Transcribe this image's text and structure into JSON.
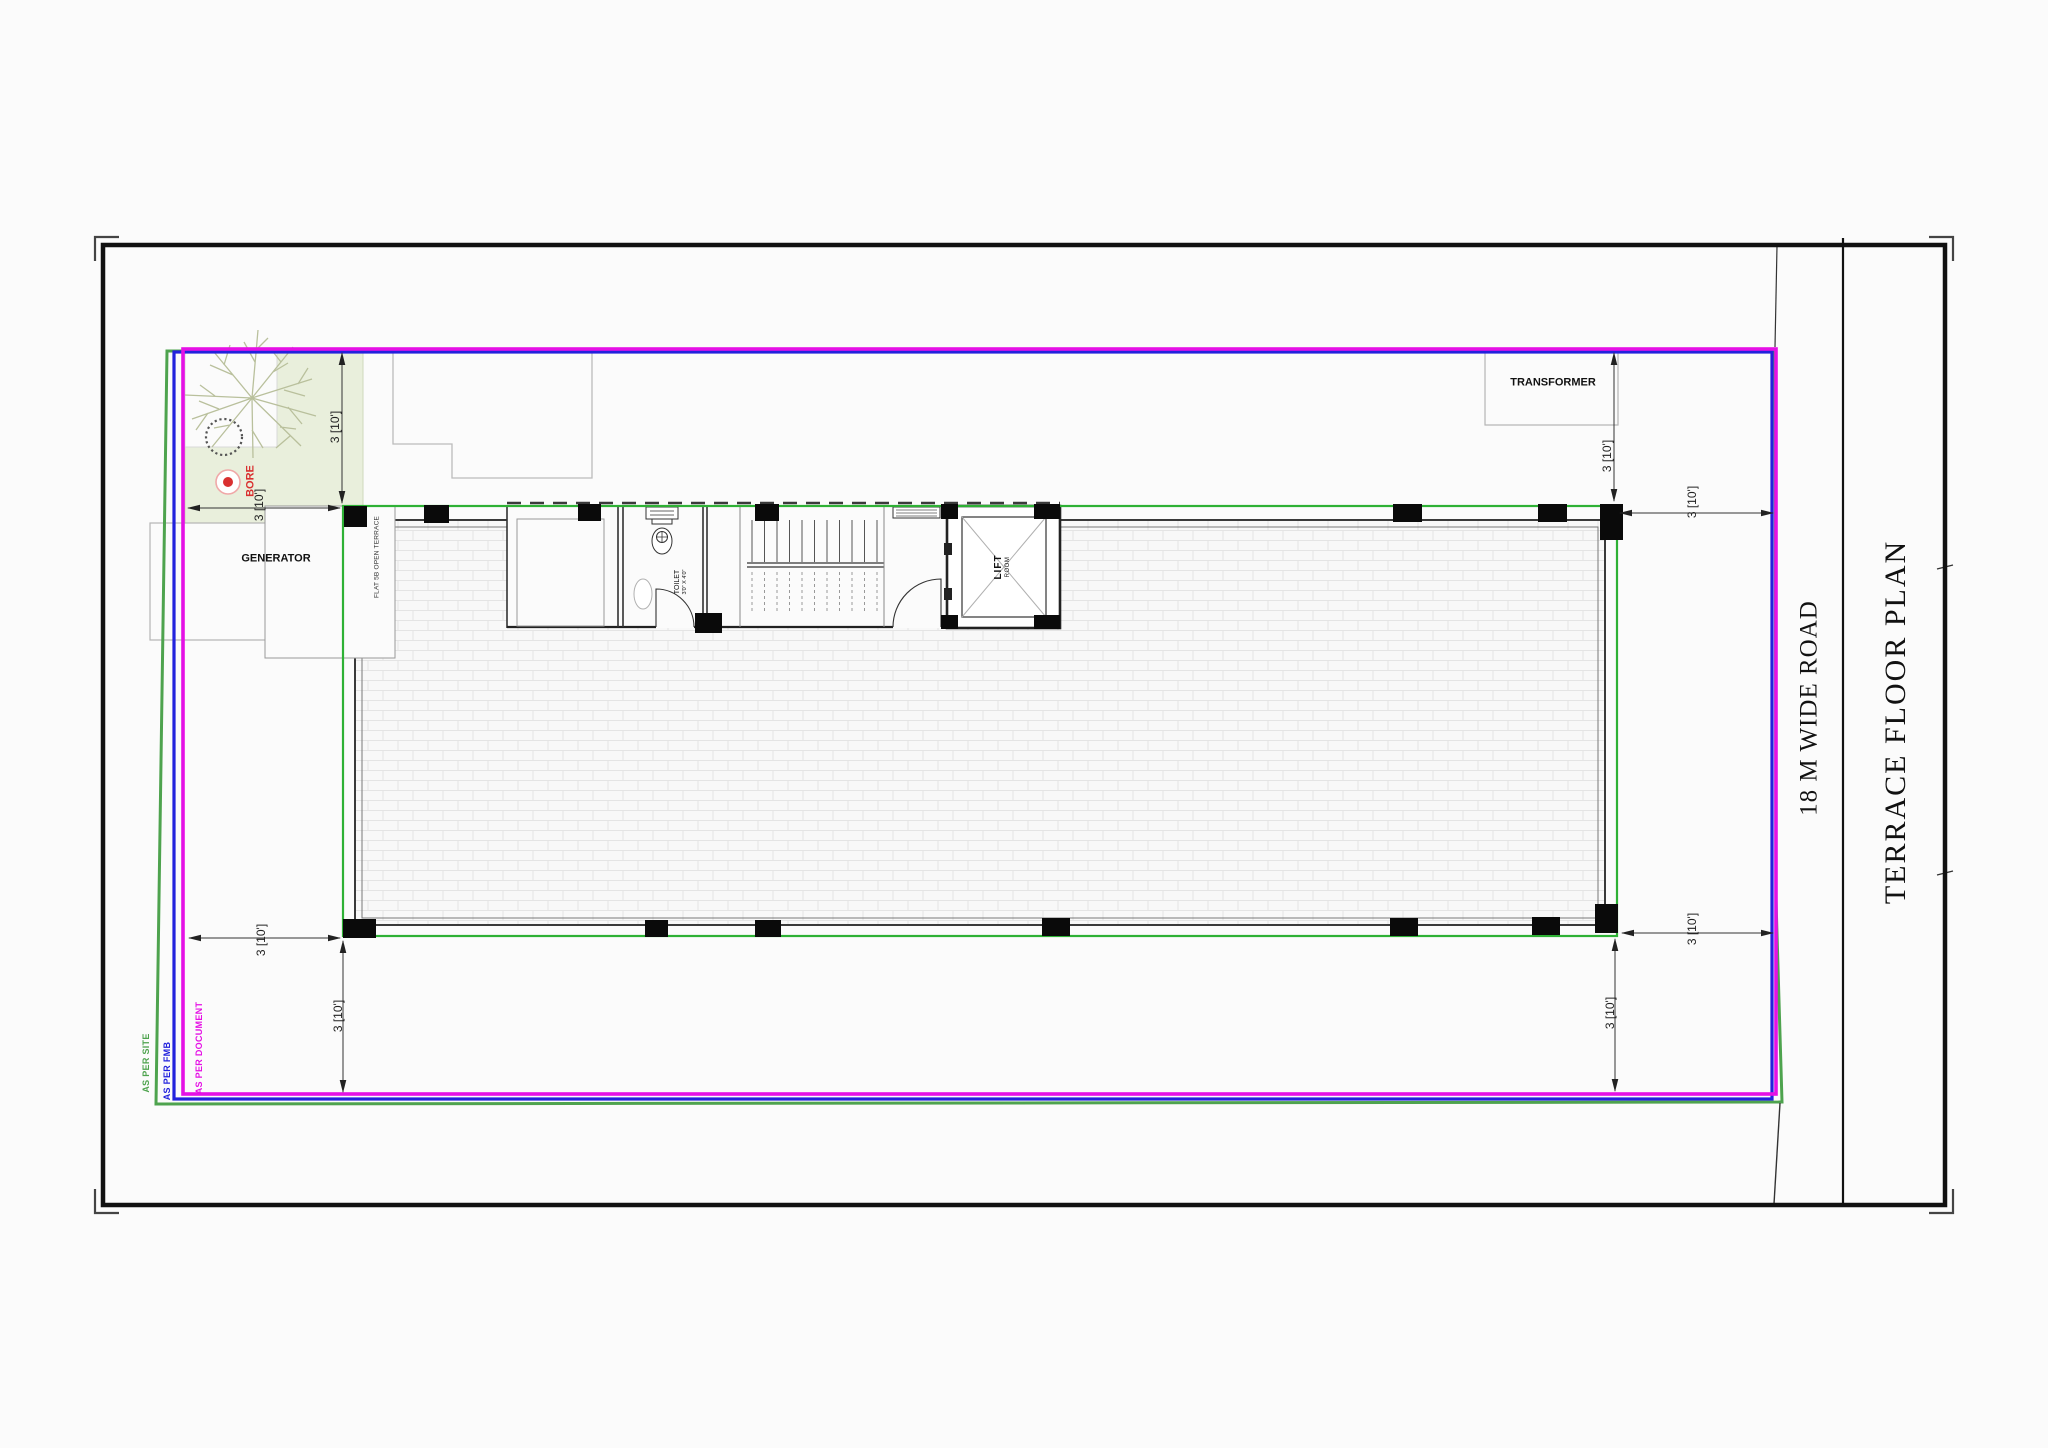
{
  "drawing": {
    "title": "TERRACE FLOOR PLAN",
    "road_label": "18 M WIDE ROAD"
  },
  "labels": {
    "transformer": "TRANSFORMER",
    "generator": "GENERATOR",
    "bore": "BORE",
    "flat_terrace": "FLAT 5B OPEN TERRACE",
    "toilet_name": "TOILET",
    "toilet_size": "3'0\" X 4'0\"",
    "lift_name": "LIFT",
    "lift_sub": "ROOM"
  },
  "dimensions": {
    "setback_label": "3 [10']"
  },
  "boundary_legend": {
    "site": {
      "label": "AS PER SITE",
      "color": "#4ea34e"
    },
    "fmb": {
      "label": "AS PER FMB",
      "color": "#2222dd"
    },
    "document": {
      "label": "AS PER DOCUMENT",
      "color": "#e511e5"
    }
  },
  "colors": {
    "building_outline": "#2eb135",
    "setback_fill": "#e9efdc",
    "bore_red": "#d93030"
  }
}
